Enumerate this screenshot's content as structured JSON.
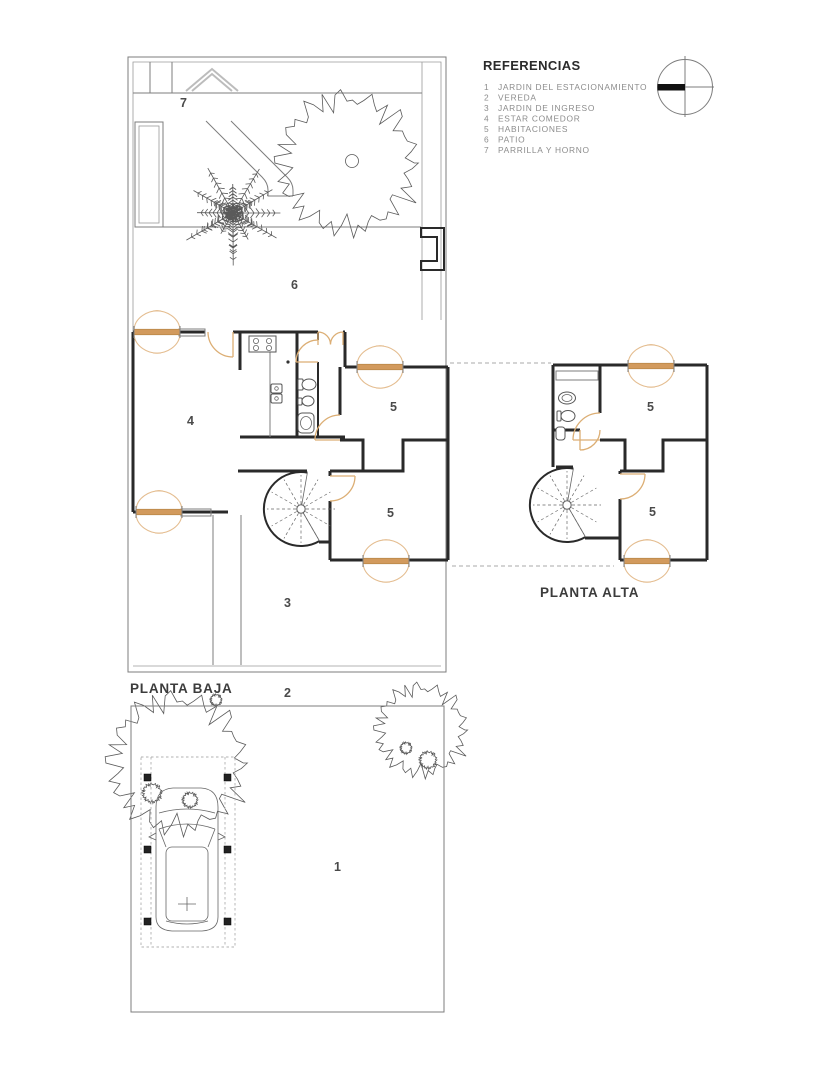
{
  "legend": {
    "title": "REFERENCIAS",
    "items": [
      {
        "num": "1",
        "label": "JARDIN DEL ESTACIONAMIENTO"
      },
      {
        "num": "2",
        "label": "VEREDA"
      },
      {
        "num": "3",
        "label": "JARDIN DE INGRESO"
      },
      {
        "num": "4",
        "label": "ESTAR COMEDOR"
      },
      {
        "num": "5",
        "label": "HABITACIONES"
      },
      {
        "num": "6",
        "label": "PATIO"
      },
      {
        "num": "7",
        "label": "PARRILLA Y HORNO"
      }
    ]
  },
  "plan_titles": {
    "ground": "PLANTA BAJA",
    "upper": "PLANTA ALTA"
  },
  "room_labels": {
    "ground": {
      "parrilla": "7",
      "patio": "6",
      "estar_comedor": "4",
      "habitacion_top": "5",
      "habitacion_bottom": "5",
      "jardin_ingreso": "3",
      "vereda": "2",
      "jardin_estacionamiento": "1"
    },
    "upper": {
      "habitacion_top": "5",
      "habitacion_bottom": "5"
    }
  },
  "colors": {
    "window_bar": "#d29a5d",
    "window_arc": "#e4bd90",
    "door_arc": "#dcae74",
    "wall": "#2a2a2a",
    "thin_line": "#888888",
    "legend_text": "#8c8c8c",
    "label_text": "#4a4a4a"
  },
  "icons": {
    "north_indicator": "circle-with-crosshair-and-solid-bar",
    "tree": "scribbled-canopy-outline",
    "palm_tree": "radial-frond-plant",
    "car": "car-top-view",
    "spiral_stair": "spiral-staircase",
    "window": "double-casement-swing-arcs",
    "door": "quarter-circle-swing"
  }
}
